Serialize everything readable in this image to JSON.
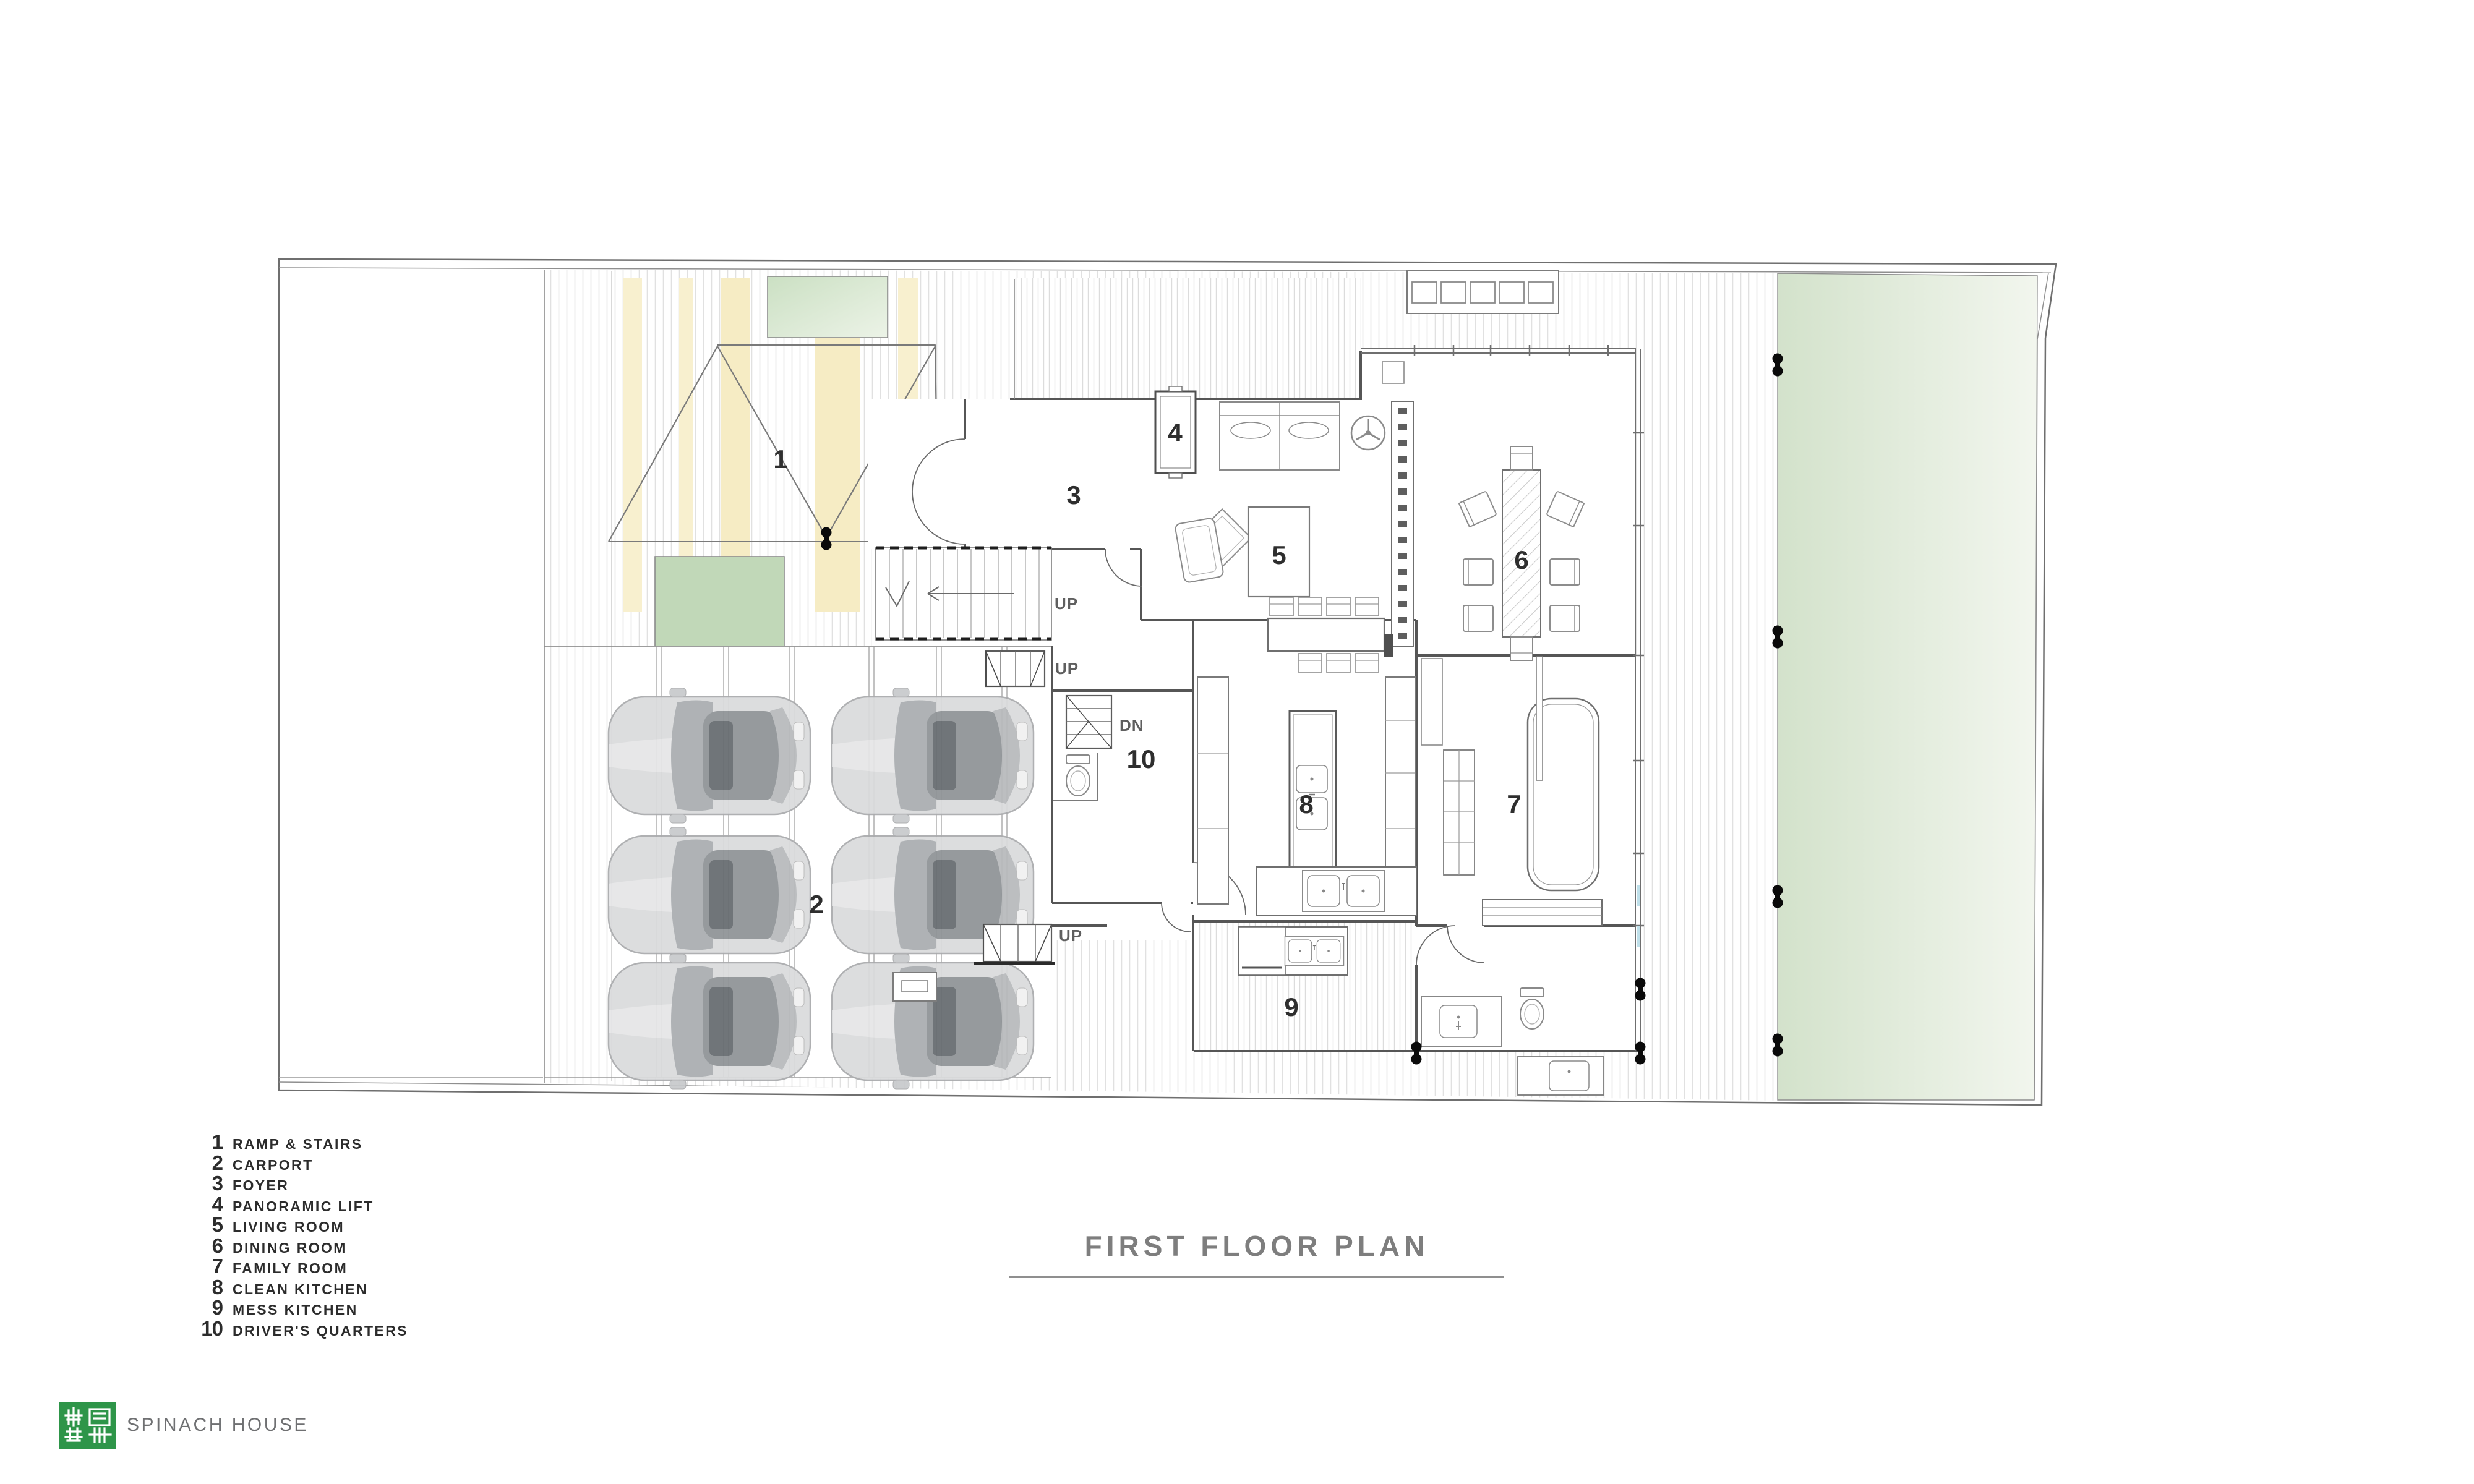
{
  "title": {
    "text": "FIRST FLOOR PLAN"
  },
  "legend": {
    "items": [
      {
        "num": "1",
        "label": "RAMP & STAIRS"
      },
      {
        "num": "2",
        "label": "CARPORT"
      },
      {
        "num": "3",
        "label": "FOYER"
      },
      {
        "num": "4",
        "label": "PANORAMIC LIFT"
      },
      {
        "num": "5",
        "label": "LIVING ROOM"
      },
      {
        "num": "6",
        "label": "DINING ROOM"
      },
      {
        "num": "7",
        "label": "FAMILY ROOM"
      },
      {
        "num": "8",
        "label": "CLEAN KITCHEN"
      },
      {
        "num": "9",
        "label": "MESS KITCHEN"
      },
      {
        "num": "10",
        "label": "DRIVER'S QUARTERS"
      }
    ]
  },
  "footer": {
    "brand": "SPINACH HOUSE"
  },
  "plan": {
    "room_labels": [
      {
        "num": "1"
      },
      {
        "num": "2"
      },
      {
        "num": "3"
      },
      {
        "num": "4"
      },
      {
        "num": "5"
      },
      {
        "num": "6"
      },
      {
        "num": "7"
      },
      {
        "num": "8"
      },
      {
        "num": "9"
      },
      {
        "num": "10"
      }
    ],
    "annotations": [
      {
        "text": "UP"
      },
      {
        "text": "DN"
      },
      {
        "text": "UP"
      },
      {
        "text": "UP"
      }
    ],
    "colors": {
      "lawn_green": "#d5e3cd",
      "planter_green": "#c1d8b8",
      "ramp_stripe_yellow": "#f8f0cf",
      "logo_green": "#2e9549",
      "line_gray": "#6b6b6b",
      "label_ink": "#2e2e2e",
      "marker_black": "#0a0a0a",
      "window_glass_blue": "#bfe0ea"
    }
  }
}
